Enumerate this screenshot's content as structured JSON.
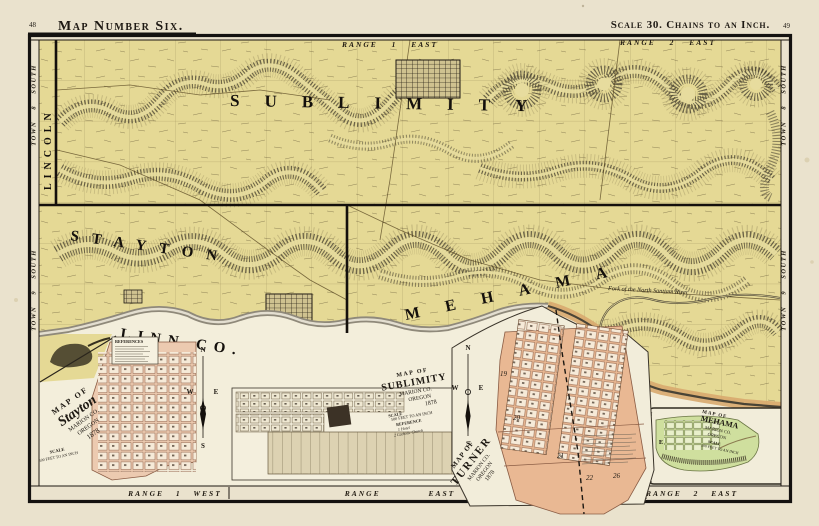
{
  "page": {
    "left_page_number": "48",
    "title": "Map Number Six.",
    "scale_note": "Scale 30. Chains to an Inch.",
    "right_page_number": "49"
  },
  "map": {
    "townships": {
      "sublimity": "SUBLIMITY",
      "stayton": "STAYTON",
      "mehama": "MEHAMA",
      "lincoln": "LINCOLN"
    },
    "county": "LINN CO.",
    "river": "Fork of the North Santiam River",
    "ranges": {
      "top_left": "RANGE 1 EAST",
      "top_right": "RANGE 2 EAST",
      "bottom_left": "RANGE 1 WEST",
      "bottom_center": "RANGE EAST",
      "bottom_right": "RANGE 2 EAST"
    },
    "towns": {
      "t8": "TOWN 8 SOUTH",
      "t9": "TOWN 9 SOUTH"
    }
  },
  "compass": {
    "n": "N",
    "s": "S",
    "e": "E",
    "w": "W"
  },
  "insets": {
    "stayton": {
      "map_of": "MAP OF",
      "name": "Stayton",
      "county": "MARION CO.",
      "state": "OREGON",
      "year": "1878",
      "scale1": "SCALE",
      "scale2": "500 FEET TO AN INCH",
      "references": "REFERENCES"
    },
    "sublimity": {
      "map_of": "MAP OF",
      "name": "SUBLIMITY",
      "county": "MARION CO.",
      "state": "OREGON",
      "year": "1878",
      "scale1": "SCALE",
      "scale2": "500 FEET TO AN INCH",
      "ref_header": "REFERENCE",
      "ref1": "1 Hotel",
      "ref2": "2 Catholic Church"
    },
    "turner": {
      "map_of": "MAP OF",
      "name": "TURNER",
      "county": "MARION CO.",
      "state": "OREGON",
      "year": "1878",
      "blocks": [
        "19",
        "20",
        "21",
        "22",
        "26"
      ]
    },
    "mehama": {
      "map_of": "MAP OF",
      "name": "MEHAMA",
      "county": "MARION CO.",
      "state": "OREGON",
      "scale1": "SCALE",
      "scale2": "500 FEET TO AN INCH"
    }
  },
  "colors": {
    "paper": "#eae2cd",
    "map_yellow": "#e5d995",
    "ink": "#1d1812",
    "hill": "#4f4836",
    "stayton_pink": "#eccab0",
    "turner_pink": "#e9b893",
    "sublimity_tan": "#d9ceae",
    "mehama_green": "#cfdf9e",
    "river_tan": "#d8a96e"
  }
}
